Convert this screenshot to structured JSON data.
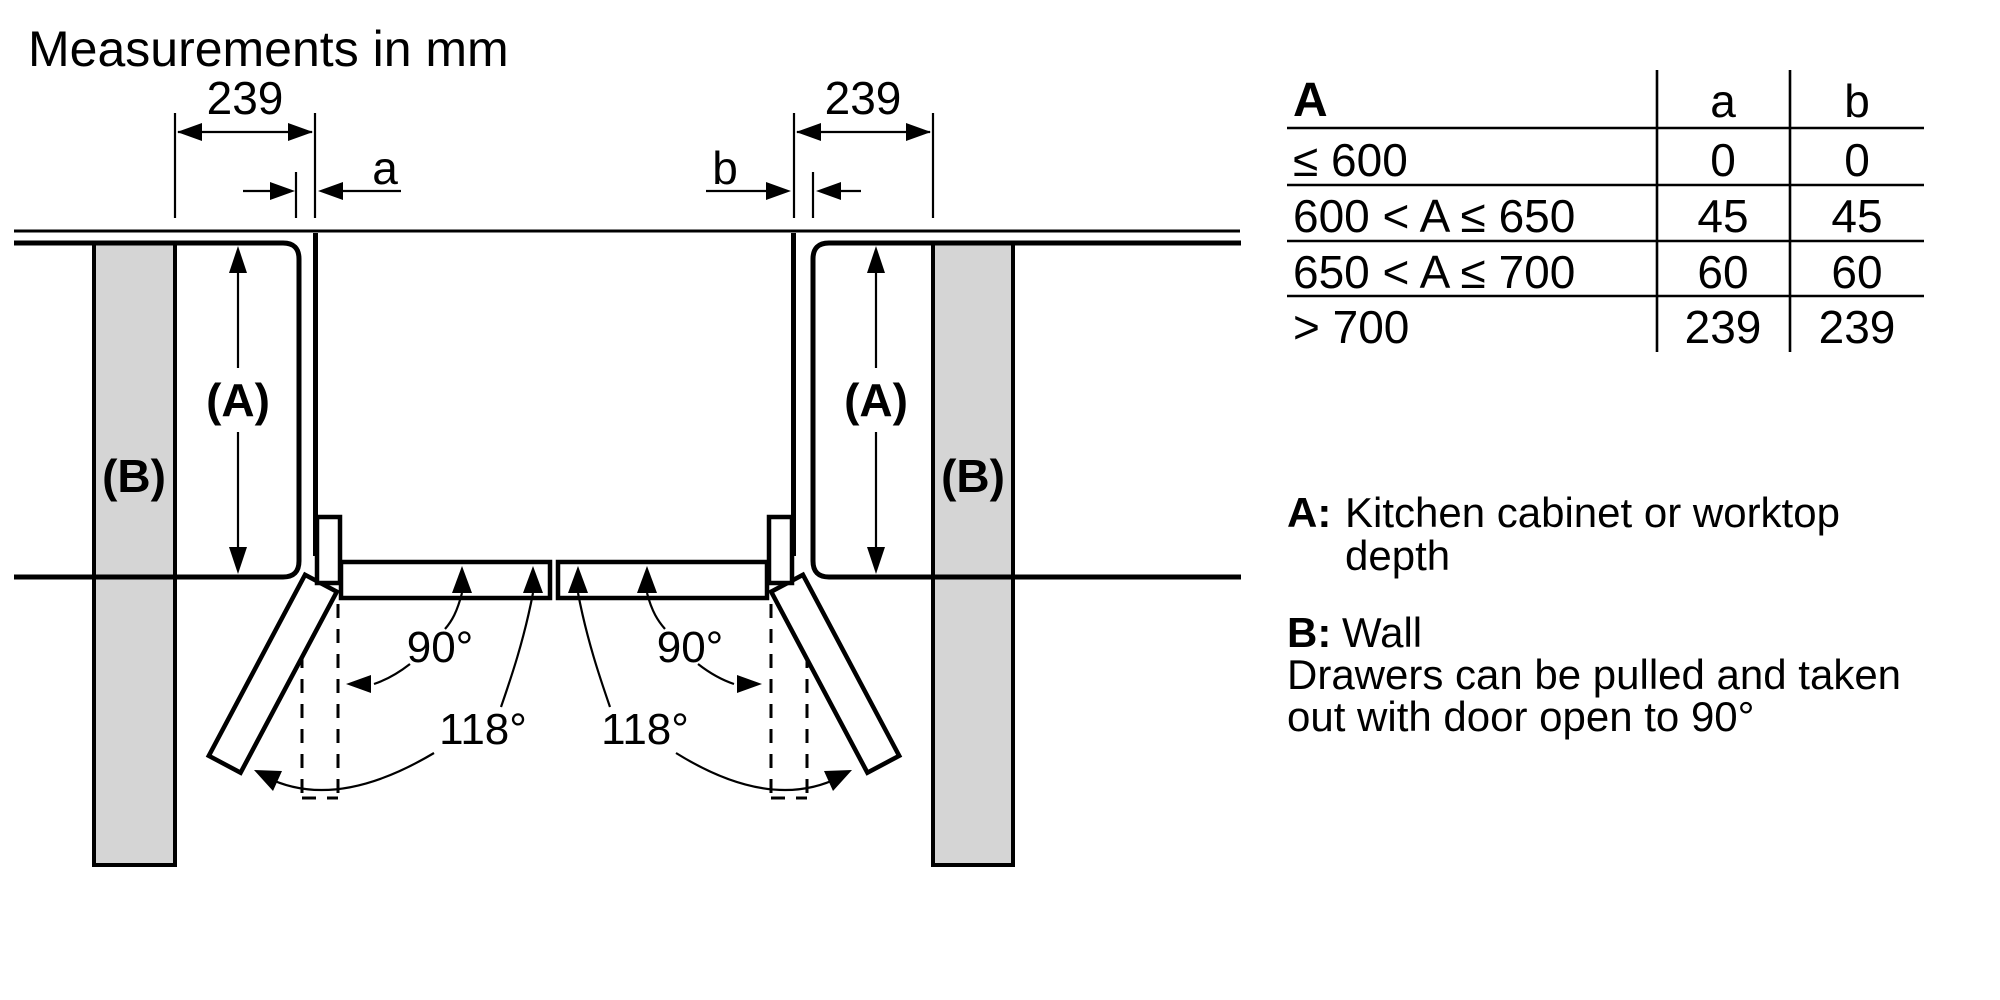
{
  "title": "Measurements in mm",
  "diagram": {
    "left_clearance": "239",
    "right_clearance": "239",
    "left_gap_label": "a",
    "right_gap_label": "b",
    "cabinet_label": "(A)",
    "wall_label": "(B)",
    "angle_open": "90°",
    "angle_max": "118°"
  },
  "table": {
    "header": {
      "range": "A",
      "a": "a",
      "b": "b"
    },
    "rows": [
      {
        "range": "≤ 600",
        "a": "0",
        "b": "0"
      },
      {
        "range": "600 < A ≤ 650",
        "a": "45",
        "b": "45"
      },
      {
        "range": "650 < A ≤ 700",
        "a": "60",
        "b": "60"
      },
      {
        "range": "> 700",
        "a": "239",
        "b": "239"
      }
    ]
  },
  "legend": {
    "a_key": "A:",
    "a_text_line1": "Kitchen cabinet or worktop",
    "a_text_line2": "depth",
    "b_key": "B:",
    "b_text": "Wall",
    "note_line1": "Drawers can be pulled and taken",
    "note_line2": "out with door open to 90°"
  }
}
